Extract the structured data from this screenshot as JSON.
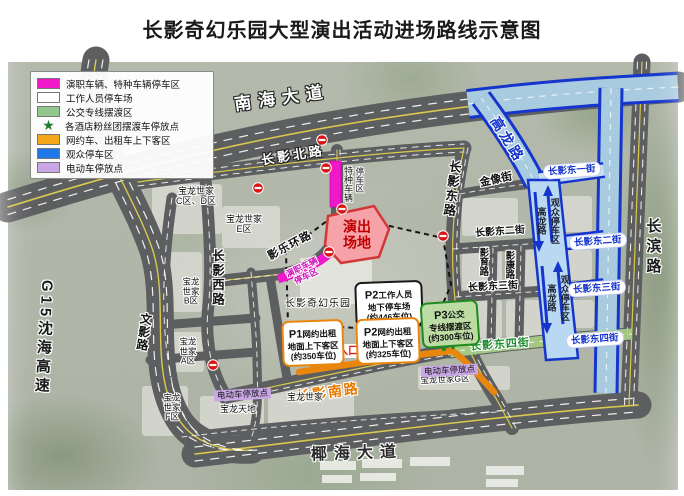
{
  "title": "长影奇幻乐园大型演出活动进场路线示意图",
  "legend": {
    "items": [
      {
        "type": "rect",
        "color": "#F018C8",
        "label": "演职车辆、特种车辆停车区"
      },
      {
        "type": "rect",
        "color": "#FFFFFF",
        "label": "工作人员停车场"
      },
      {
        "type": "rect",
        "color": "#92C88E",
        "label": "公交专线摆渡区"
      },
      {
        "type": "star",
        "color": "#1F7A2E",
        "label": "各酒店粉丝团摆渡车停放点"
      },
      {
        "type": "rect",
        "color": "#F5A71B",
        "label": "网约车、出租车上下客区"
      },
      {
        "type": "rect",
        "color": "#1E78E8",
        "label": "观众停车区"
      },
      {
        "type": "rect",
        "color": "#C9A7E4",
        "label": "电动车停放点"
      }
    ]
  },
  "roads": {
    "nanhai": "南海大道",
    "yehai": "椰海大道",
    "g15": "G15沈海高速",
    "changbin": "长滨路",
    "changying_north": "长影北路",
    "changying_east_rd": "长影东路",
    "changying_west_rd": "长影西路",
    "wenying": "文影路",
    "yingle_ring": "影乐环路",
    "changying_south": "长影南路",
    "jinxiang": "金像街",
    "dong2_black": "长影东二街",
    "dong3_black": "长影东三街",
    "dong4_green": "长影东四街",
    "yingyu": "影育路",
    "yingkang": "影康路",
    "gaolong": "高龙路",
    "dong1_pill": "长影东一街",
    "dong2_pill": "长影东二街",
    "dong3_pill": "长影东三街",
    "dong4_pill": "长影东四街"
  },
  "areas": {
    "stage": "演出\n场地",
    "park": "长影奇幻乐园",
    "special_vehicle_col1": "特种车辆",
    "special_vehicle_col2": "停车区",
    "cast_parking": "演职车辆\n停车区",
    "strip_text": "观众停车区\n高龙路",
    "entrance": "入口",
    "ev_parking": "电动车停放点",
    "blocks": {
      "cd": "宝龙世家\nC区、D区",
      "e": "宝龙世家\nE区",
      "b": "宝龙\n世家\nB区",
      "a": "宝龙\n世家\nA区",
      "f": "宝龙\n世家\nF区",
      "tiandi": "宝龙天地",
      "baolong": "宝龙世家",
      "g": "宝龙世家G区"
    }
  },
  "boxes": {
    "p1": {
      "tag": "P1",
      "line1": "网约出租",
      "line2": "地面上下客区",
      "line3": "(约350车位)"
    },
    "p2": {
      "tag": "P2",
      "line1": "网约出租",
      "line2": "地面上下客区",
      "line3": "(约325车位)"
    },
    "p2_staff": {
      "tag": "P2",
      "line1": "工作人员",
      "line2": "地下停车场",
      "line3": "(约446车位)"
    },
    "p3": {
      "tag": "P3",
      "line1": "公交",
      "line2": "专线摆渡区",
      "line3": "(约300车位)"
    }
  },
  "icons": {
    "star": "★"
  },
  "colors": {
    "magenta": "#F018C8",
    "orange": "#E8860D",
    "route_blue": "#1535CC",
    "light_blue": "#A9CBDF",
    "green": "#1F8B1F",
    "stage_red": "#C00000",
    "purple": "#C9A7E4"
  }
}
